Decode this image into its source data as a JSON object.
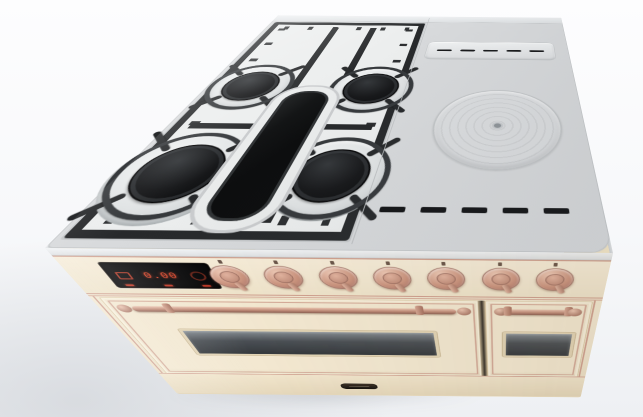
{
  "image": {
    "subject": "Freestanding dual-fuel range cooker, cream enamel finish with copper hardware",
    "view": "three-quarter elevated front-left product render",
    "background": "plain light studio backdrop"
  },
  "colors": {
    "body_cream": "#f1e6cf",
    "copper_trim": "#cfa08f",
    "knob_copper": "#cb947f",
    "cooktop_gray": "#d8dadc",
    "grate_black": "#27292b",
    "porcelain_white": "#eceeee",
    "display_red": "#ef4f30",
    "oven_glass": "#4a4f54"
  },
  "cooktop": {
    "gas_burners": [
      {
        "name": "rear-left"
      },
      {
        "name": "rear-right"
      },
      {
        "name": "front-left"
      },
      {
        "name": "front-right"
      }
    ],
    "center_griddle_pad": {
      "shape": "oval",
      "material": "cast-iron"
    },
    "simmer_plate": {
      "shape": "round",
      "rings": 8
    },
    "vent_slots_back": {
      "count": 5
    },
    "vent_slots_front": {
      "count": 5
    }
  },
  "control_panel": {
    "display": {
      "value": "0.00",
      "status_lights": 3,
      "icons": [
        "burner-icon",
        "timer-dial-icon"
      ]
    },
    "knobs": [
      {
        "name": "knob-1"
      },
      {
        "name": "knob-2"
      },
      {
        "name": "knob-3"
      },
      {
        "name": "knob-4"
      },
      {
        "name": "knob-5"
      },
      {
        "name": "knob-6"
      },
      {
        "name": "knob-7"
      }
    ]
  },
  "oven_doors": [
    {
      "name": "main-oven",
      "window": true,
      "handle": true
    },
    {
      "name": "side-oven",
      "window": true,
      "handle": true
    }
  ],
  "badge": {
    "label": ""
  }
}
